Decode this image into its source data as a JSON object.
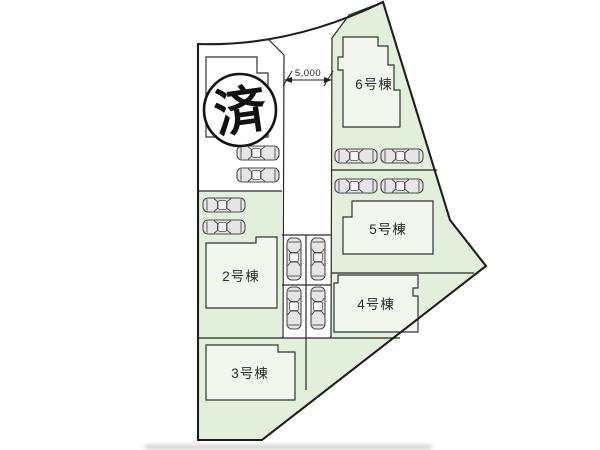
{
  "plan": {
    "title": "housing-site-plan",
    "sold_badge": "済",
    "road_dimension": "5,000",
    "buildings": [
      {
        "id": "2",
        "label": "2号棟"
      },
      {
        "id": "3",
        "label": "3号棟"
      },
      {
        "id": "4",
        "label": "4号棟"
      },
      {
        "id": "5",
        "label": "5号棟"
      },
      {
        "id": "6",
        "label": "6号棟"
      }
    ],
    "colors": {
      "lot_green": "#e2efda",
      "white_area": "#ffffff",
      "line": "#2a2a2a",
      "car_body": "#e6e6e6",
      "car_window": "#f4f4f4"
    }
  }
}
